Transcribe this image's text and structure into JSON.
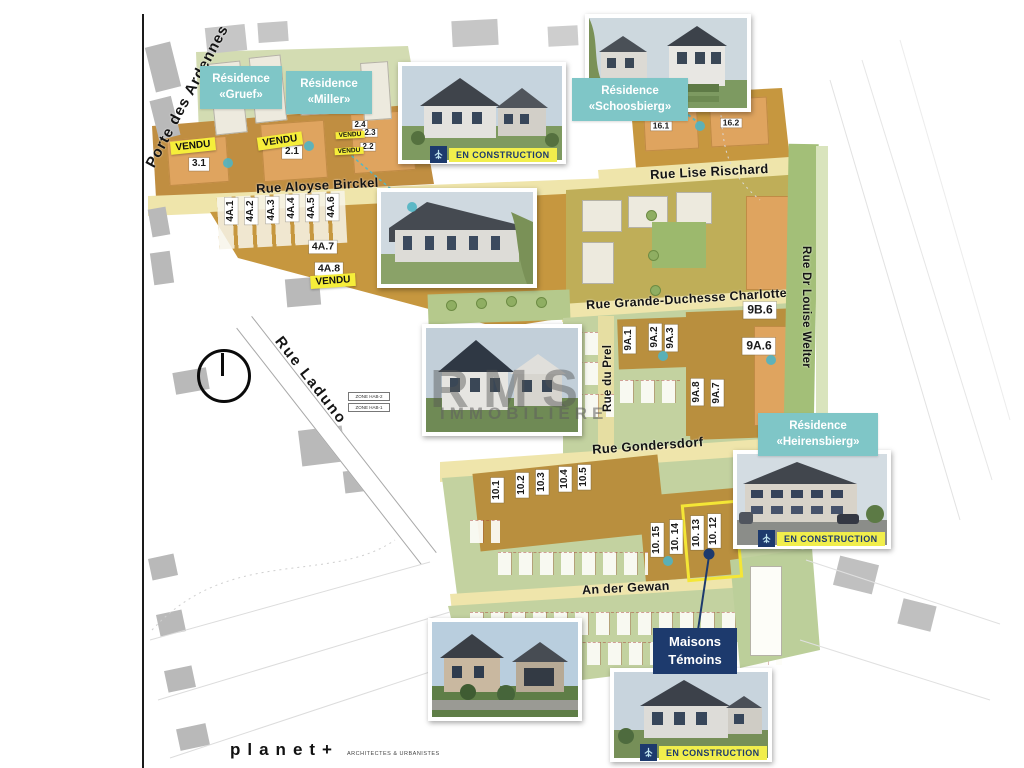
{
  "map": {
    "streets": {
      "porte_des_ardennes": "Porte des Ardennes",
      "rue_aloyse_birckel": "Rue Aloyse Birckel",
      "rue_lise_rischard": "Rue Lise Rischard",
      "rue_grande_duchesse_charlotte": "Rue Grande-Duchesse Charlotte",
      "rue_dr_louise_welter": "Rue Dr Louise Welter",
      "rue_du_prel": "Rue du Prel",
      "rue_laduno": "Rue Laduno",
      "rue_gondersdorf": "Rue Gondersdorf",
      "an_der_gewan": "An der Gewan"
    },
    "residences": {
      "gruef": {
        "line1": "Résidence",
        "line2": "«Gruef»"
      },
      "miller": {
        "line1": "Résidence",
        "line2": "«Miller»"
      },
      "schoosbierg": {
        "line1": "Résidence",
        "line2": "«Schoosbierg»"
      },
      "heirensbierg": {
        "line1": "Résidence",
        "line2": "«Heirensbierg»"
      }
    },
    "plots": {
      "p3_1": "3.1",
      "p2_1": "2.1",
      "p2_2": "2.2",
      "p2_3": "2.3",
      "p2_4": "2.4",
      "p4a_1": "4A.1",
      "p4a_2": "4A.2",
      "p4a_3": "4A.3",
      "p4a_4": "4A.4",
      "p4a_5": "4A.5",
      "p4a_6": "4A.6",
      "p4a_7": "4A.7",
      "p4a_8": "4A.8",
      "p16_1": "16.1",
      "p16_2": "16.2",
      "p9b_6": "9B.6",
      "p9a_1": "9A.1",
      "p9a_2": "9A.2",
      "p9a_3": "9A.3",
      "p9a_6": "9A.6",
      "p9a_7": "9A.7",
      "p9a_8": "9A.8",
      "p10_1": "10.1",
      "p10_2": "10.2",
      "p10_3": "10.3",
      "p10_4": "10.4",
      "p10_5": "10.5",
      "p10_12": "10. 12",
      "p10_13": "10. 13",
      "p10_14": "10. 14",
      "p10_15": "10. 15"
    },
    "badges": {
      "vendu": "VENDU",
      "en_construction": "EN CONSTRUCTION"
    },
    "maisons_temoins": {
      "line1": "Maisons",
      "line2": "Témoins"
    },
    "zones": {
      "hab2": "ZONE HAB-2",
      "hab1": "ZONE HAB-1"
    }
  },
  "watermark": {
    "text": "RMS",
    "subtext": "IMMOBILIÈRE"
  },
  "footer": {
    "brand": "planet+",
    "tagline": "ARCHITECTES & URBANISTES"
  },
  "colors": {
    "teal": "#7fc6c7",
    "navy": "#1d3a6d",
    "vendu_yellow": "#f6ee3a",
    "construction_yellow": "#f1ee4c",
    "plot_tan": "#c6973f",
    "plot_dark_tan": "#b98f3e",
    "building_orange": "#dfa45f",
    "road_yellow": "#efe5ab",
    "green_light": "#c3d2a0",
    "map_khaki": "#bfae58"
  }
}
